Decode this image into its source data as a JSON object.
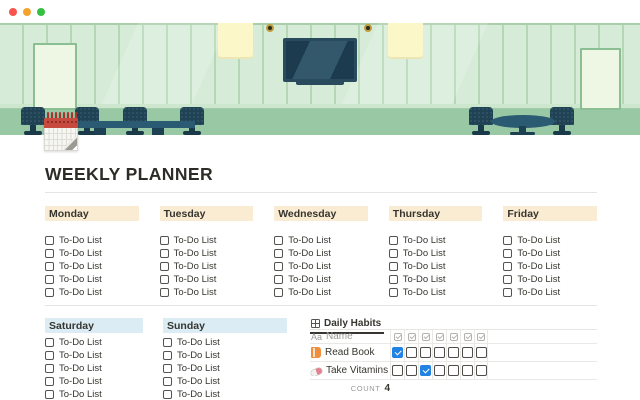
{
  "window": {
    "traffic_lights": [
      {
        "name": "close",
        "color": "#f8544d"
      },
      {
        "name": "minimize",
        "color": "#f5a32c"
      },
      {
        "name": "zoom",
        "color": "#35c13f"
      }
    ]
  },
  "header_illustration": {
    "description": "meeting-room scene with paneled green wall, wall TV, ceiling lights, whiteboards, conference table with chairs, round table with chairs",
    "colors": {
      "wall": "#d7ecd8",
      "wall_lines": "#b5d7b6",
      "baseboard": "#cde6ce",
      "floor": "#98c8a4",
      "furniture_dark": "#1f4254",
      "table_top": "#2b5b72",
      "tv_body": "#2a4a5e",
      "tv_screen": "#1d3b4e",
      "light_panel": "#fbf7c9",
      "whiteboard": "#edf7e3",
      "calendar_red": "#c74a3e"
    }
  },
  "title": "WEEKLY PLANNER",
  "todo_label": "To-Do List",
  "week_days": [
    {
      "name": "Monday",
      "todos": [
        "To-Do List",
        "To-Do List",
        "To-Do List",
        "To-Do List",
        "To-Do List"
      ]
    },
    {
      "name": "Tuesday",
      "todos": [
        "To-Do List",
        "To-Do List",
        "To-Do List",
        "To-Do List",
        "To-Do List"
      ]
    },
    {
      "name": "Wednesday",
      "todos": [
        "To-Do List",
        "To-Do List",
        "To-Do List",
        "To-Do List",
        "To-Do List"
      ]
    },
    {
      "name": "Thursday",
      "todos": [
        "To-Do List",
        "To-Do List",
        "To-Do List",
        "To-Do List",
        "To-Do List"
      ]
    },
    {
      "name": "Friday",
      "todos": [
        "To-Do List",
        "To-Do List",
        "To-Do List",
        "To-Do List",
        "To-Do List"
      ]
    }
  ],
  "weekend_days": [
    {
      "name": "Saturday",
      "todos": [
        "To-Do List",
        "To-Do List",
        "To-Do List",
        "To-Do List",
        "To-Do List"
      ]
    },
    {
      "name": "Sunday",
      "todos": [
        "To-Do List",
        "To-Do List",
        "To-Do List",
        "To-Do List",
        "To-Do List"
      ]
    }
  ],
  "habits_table": {
    "tab_label": "Daily Habits",
    "name_column": {
      "icon": "Aa",
      "label": "Name"
    },
    "day_checkbox_columns": 7,
    "rows": [
      {
        "icon": "book-icon",
        "name": "Read Book",
        "checks": [
          true,
          false,
          false,
          false,
          false,
          false,
          false
        ]
      },
      {
        "icon": "pill-icon",
        "name": "Take Vitamins",
        "checks": [
          false,
          false,
          true,
          false,
          false,
          false,
          false
        ]
      }
    ],
    "footer": {
      "label": "COUNT",
      "value": "4"
    }
  },
  "colors": {
    "weekday_header_bg": "#faecd2",
    "weekend_header_bg": "#dbecf4",
    "checked_checkbox": "#2383e2",
    "text": "#37352f",
    "muted_text": "#9b9a97",
    "divider": "#e6e5e2"
  }
}
